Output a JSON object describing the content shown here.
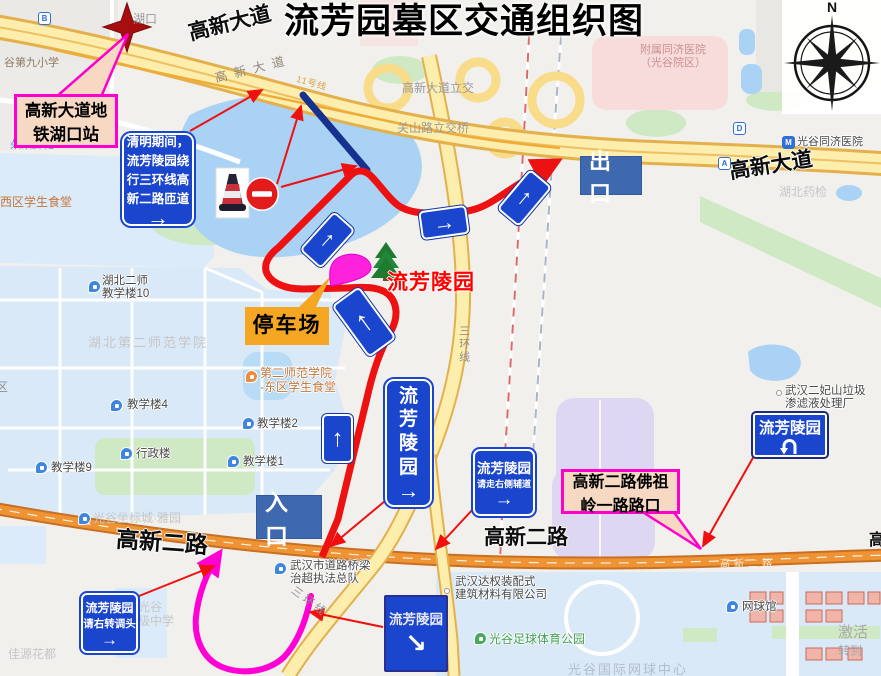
{
  "title": "流芳园墓区交通组织图",
  "compass": {
    "north_label": "N"
  },
  "callouts": {
    "metro": {
      "line1": "高新大道地",
      "line2": "铁湖口站"
    },
    "fozuling": {
      "line1": "高新二路佛祖",
      "line2": "岭一路路口"
    }
  },
  "signs": {
    "qingming": {
      "line1": "清明期间，",
      "line2": "流芳陵园绕",
      "line3": "行三环线高",
      "line4": "新二路匝道",
      "arrow": "→"
    },
    "vertical_cemetery": {
      "char1": "流",
      "char2": "芳",
      "char3": "陵",
      "char4": "园",
      "arrow": "→"
    },
    "side_road": {
      "line1": "流芳陵园",
      "line2": "请走右侧辅道",
      "arrow": "→"
    },
    "u_turn": {
      "label": "流芳陵园"
    },
    "diagonal": {
      "label": "流芳陵园",
      "arrow": "↘"
    },
    "right_turn": {
      "line1": "流芳陵园",
      "line2": "请右转调头",
      "arrow": "→"
    },
    "exit_label": "出口",
    "entrance_label": "入口",
    "parking_label": "停车场",
    "cemetery_red_label": "流芳陵园",
    "nav_arrow_up": "↑",
    "nav_arrow_right": "→"
  },
  "roads": {
    "gaoxin_avenue": "高新大道",
    "gaoxin_avenue_onroad": "高新大道",
    "gaoxin_avenue_right": "高新大道",
    "gaoxin_interchange": "高新大道立交",
    "guanshan_interchange": "关山路立交桥",
    "third_ring_vertical": "三环线",
    "third_ring_bottom": "三环线",
    "gaoxin_2nd_left": "高新二路",
    "gaoxin_2nd_mid": "高新二路",
    "gaoxin_2nd_onroad": "高新二路",
    "gaoxin_2nd_partial": "高",
    "metro_line_11": "11号线"
  },
  "pois": {
    "school9": "谷第九小学",
    "flowers": "朵朵鲜花",
    "west_canteen": "西区学生食堂",
    "qu_fragment": "区",
    "hukou_station": "湖口",
    "hb2_bldg10": {
      "line1": "湖北二师",
      "line2": "教学楼10"
    },
    "hb2_university": "湖北第二师范学院",
    "bldg4": "教学楼4",
    "bldg2": "教学楼2",
    "admin_bldg": "行政楼",
    "bldg1": "教学楼1",
    "bldg9": "教学楼9",
    "east_canteen": {
      "line1": "第二师范学院",
      "line2": "-东区学生食堂"
    },
    "zuobiao": "光谷坐标城·雅园",
    "jiayuan": "佳源花都",
    "bridge_team": {
      "line1": "武汉市道路桥梁",
      "line2": "治超执法总队"
    },
    "middle_school": {
      "line1": "光谷",
      "line2": "级中学"
    },
    "daquan": {
      "line1": "武汉达权装配式",
      "line2": "建筑材料有限公司"
    },
    "football_park": "光谷足球体育公园",
    "tennis_center": "光谷国际网球中心",
    "tennis_hall": "网球馆",
    "landfill": {
      "line1": "武汉二妃山垃圾",
      "line2": "渗滤液处理厂"
    },
    "activate_wm": {
      "line1": "激活",
      "line2": "转到"
    },
    "yaojian": "湖北药检",
    "tongji": {
      "line1": "附属同济医院",
      "line2": "（光谷院区）"
    },
    "tongji_metro": "光谷同济医院"
  },
  "markers": {
    "b": "B",
    "d": "D",
    "a": "A",
    "metro_m": "M"
  },
  "colors": {
    "route_red": "#ee1111",
    "route_magenta": "#ff00d5",
    "closed_road_navy": "#16318f",
    "sign_blue": "#1a45cd",
    "label_blue": "#3f69ae",
    "callout_fill": "#f6d8c3",
    "callout_border": "#ff00cc",
    "parking_orange": "#f5a623",
    "cemetery_red": "#ff0000",
    "road_yellow": "#fdeead",
    "road_orange": "#ee9435"
  }
}
